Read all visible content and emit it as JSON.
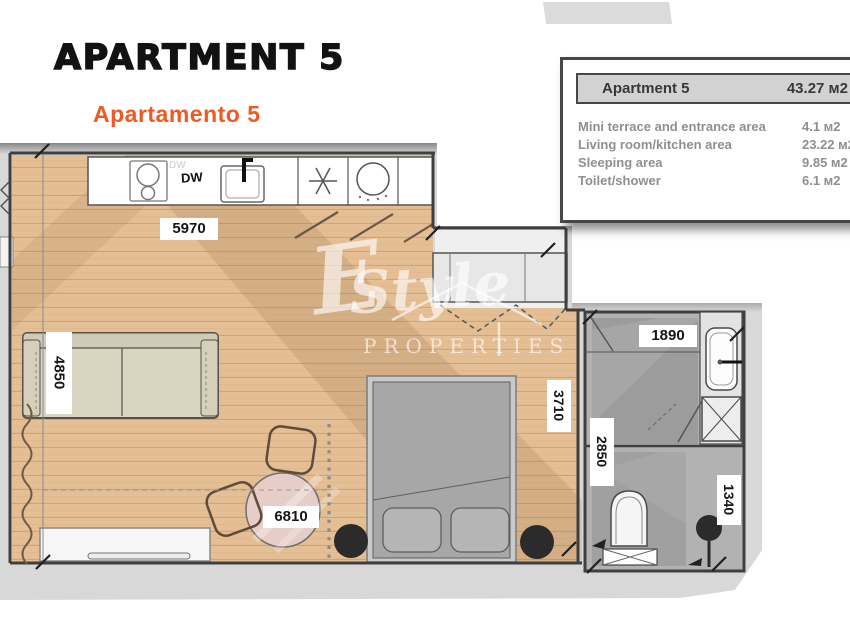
{
  "header": {
    "title": "APARTMENT 5",
    "subtitle": "Apartamento 5"
  },
  "info_box": {
    "header": {
      "name": "Apartment 5",
      "area": "43.27 м2"
    },
    "rows": [
      {
        "label": "Mini terrace and entrance area",
        "value": "4.1 м2"
      },
      {
        "label": "Living room/kitchen area",
        "value": "23.22 м2"
      },
      {
        "label": "Sleeping area",
        "value": "9.85 м2"
      },
      {
        "label": "Toilet/shower",
        "value": "6.1 м2"
      }
    ]
  },
  "plan": {
    "appliance_labels": {
      "dishwasher": "DW"
    },
    "dimensions": {
      "kitchen_wall": "5970",
      "sofa_wall": "4850",
      "living_width": "6810",
      "sleeping_width": "3710",
      "bathroom_width": "1890",
      "bathroom_depth": "2850",
      "wc_width": "1340"
    }
  },
  "watermark": {
    "prefix": "E",
    "script": "Style",
    "caption": "PROPERTIES"
  },
  "colors": {
    "accent_orange": "#EE5A22",
    "wood_floor": "#E4BE94",
    "backdrop_gray": "#D8D8D8",
    "wall_dark": "#3F3F3F",
    "tile_gray": "#B2B2B2"
  }
}
